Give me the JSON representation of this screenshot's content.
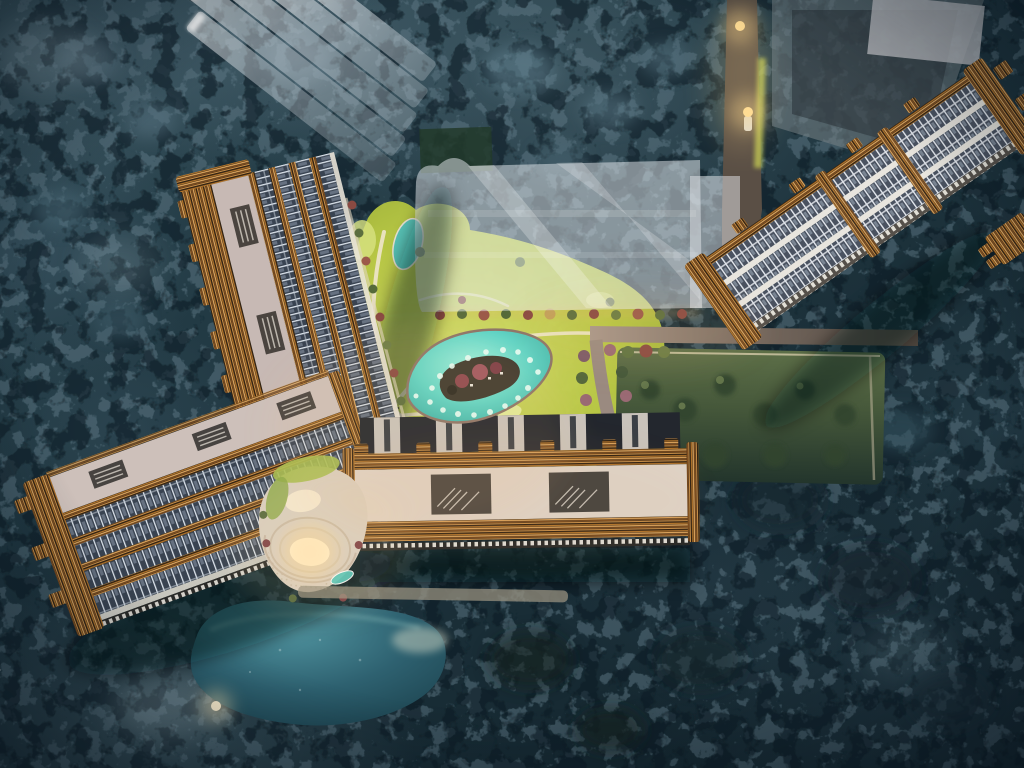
{
  "scene": {
    "type": "architectural-aerial-night-render",
    "description": "Bird's-eye night rendering of a resort residential masterplan: four gold-trimmed apartment slabs around a lit central landscape with a turquoise sculpture pool, chartreuse lawns, an amphitheater podium, a natural pond, ghosted future-phase glass massings and dense dark forest.",
    "palette": {
      "forest_dark": "#142830",
      "canopy_light": "#5e7885",
      "glass_ghost": "#e9edf2",
      "gold_mid": "#b5772c",
      "gold_hi": "#ecb063",
      "gold_dark": "#2c1f12",
      "facade_cream": "#ded3c7",
      "roof_taupe": "#c7b9b4",
      "roof_taupe_b": "#cdc0ba",
      "window_slate": "#394351",
      "mullion_white": "#dde4ec",
      "lawn_green": "#bccb45",
      "lawn_lit": "#eef2b2",
      "path_cream": "#f2e8d4",
      "plaza_cream": "#e8dcc8",
      "pool_turquoise": "#55d2c4",
      "pond_teal": "#2e6170",
      "garden_olive": "#45573a",
      "road_mauve": "#8a7a74",
      "road_dark": "#4e463e",
      "light_warm": "#ffd98d",
      "shrub_plum": "#8a4a42",
      "shrub_green": "#5c6e3e",
      "island_dark": "#3d382e",
      "bloom_plum": "#a05660"
    },
    "landmarks": {
      "north_west": "ghosted glass tower cluster",
      "north": "translucent future-phase slab massing",
      "north_east": "dark ghost block, access road with street lights",
      "west": "residential slab A with gold balcony edge",
      "south_west": "residential slab B and natural pond",
      "south": "residential slab C over forest",
      "east": "residential slab D along lit garden road",
      "center": "sculpture pool, lawns, amphitheater podium"
    }
  }
}
